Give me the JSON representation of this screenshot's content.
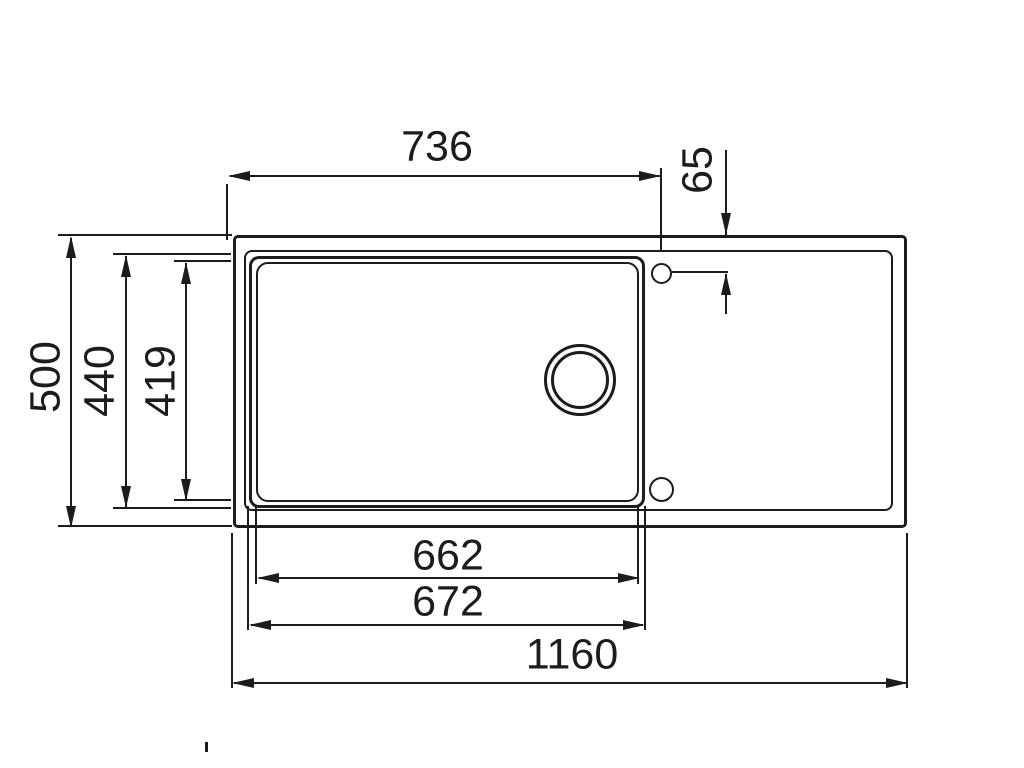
{
  "page": {
    "background_color": "#ffffff",
    "line_color": "#1c1c1c"
  },
  "drawing": {
    "type": "technical-dimension-drawing",
    "subject": "kitchen sink with bowl, drain hole, tap holes and drainboard, top view"
  },
  "dimensions": {
    "d736": {
      "value": "736",
      "orientation": "horizontal",
      "measures": "left edge to tap hole center"
    },
    "d65": {
      "value": "65",
      "orientation": "vertical",
      "measures": "top edge to tap hole center"
    },
    "d500": {
      "value": "500",
      "orientation": "vertical",
      "measures": "overall depth"
    },
    "d440": {
      "value": "440",
      "orientation": "vertical",
      "measures": "bowl outer depth"
    },
    "d419": {
      "value": "419",
      "orientation": "vertical",
      "measures": "bowl inner depth"
    },
    "d662": {
      "value": "662",
      "orientation": "horizontal",
      "measures": "bowl inner width"
    },
    "d672": {
      "value": "672",
      "orientation": "horizontal",
      "measures": "bowl outer width"
    },
    "d1160": {
      "value": "1160",
      "orientation": "horizontal",
      "measures": "overall width"
    }
  },
  "features": {
    "drain_hole": "double ring circle in bowl",
    "tap_hole_top": "small circle near top right of bowl",
    "tap_hole_bottom": "small circle near bottom right of bowl"
  }
}
